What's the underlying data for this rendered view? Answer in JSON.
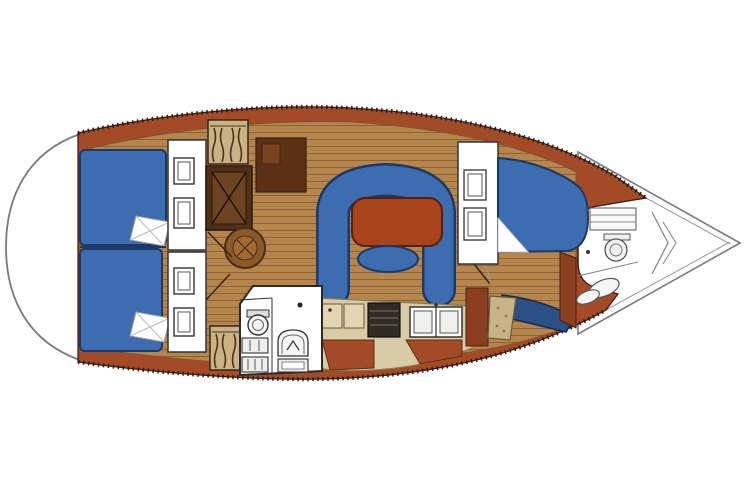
{
  "canvas": {
    "width": 744,
    "height": 496
  },
  "diagram": {
    "kind": "sailboat-interior-floorplan",
    "orientation": {
      "bow": "right",
      "stern": "left"
    },
    "regions": [
      {
        "name": "stern-swim-platform"
      },
      {
        "name": "port-aft-cabin-berth"
      },
      {
        "name": "starboard-aft-cabin-berth"
      },
      {
        "name": "aft-cabin-wardrobes"
      },
      {
        "name": "hanging-lockers"
      },
      {
        "name": "companionway-engine-box"
      },
      {
        "name": "passage-round-table"
      },
      {
        "name": "aft-head-toilet-sink"
      },
      {
        "name": "galley-stove-sinks"
      },
      {
        "name": "salon-u-settee"
      },
      {
        "name": "salon-table"
      },
      {
        "name": "salon-stool"
      },
      {
        "name": "forward-vanity-seat"
      },
      {
        "name": "forward-cabin-v-berth"
      },
      {
        "name": "forward-head-line-art"
      },
      {
        "name": "bow-anchor-locker"
      }
    ]
  },
  "colors": {
    "background": "#FFFFFF",
    "hull_brown": "#A34A26",
    "hull_edge": "#2E1A0E",
    "floor_wood": "#B5854E",
    "floor_seam": "#8F6236",
    "cushion_blue": "#3E6CB0",
    "cushion_outline": "#1C3A66",
    "berth_navy": "#2C4F86",
    "table_red": "#A8431C",
    "table_outline": "#5A1F0A",
    "counter_beige": "#D8CBA6",
    "counter_edge": "#8A7A50",
    "burner_beige": "#E2D6B2",
    "locker_tan": "#C8B386",
    "wardrobe_dark": "#5C3014",
    "engine_dark": "#4F3118",
    "engine_inner": "#6B4423",
    "cabinet_sienna": "#8B3E20",
    "stove_dark": "#2F2A22",
    "white": "#FFFFFF",
    "offwhite": "#F0F0EC",
    "deck_line": "#7A7A7A",
    "fixture_line": "#444444",
    "outline_dark": "#3A2415",
    "wood_mid": "#8B5A2B",
    "wood_light": "#A06A35"
  }
}
